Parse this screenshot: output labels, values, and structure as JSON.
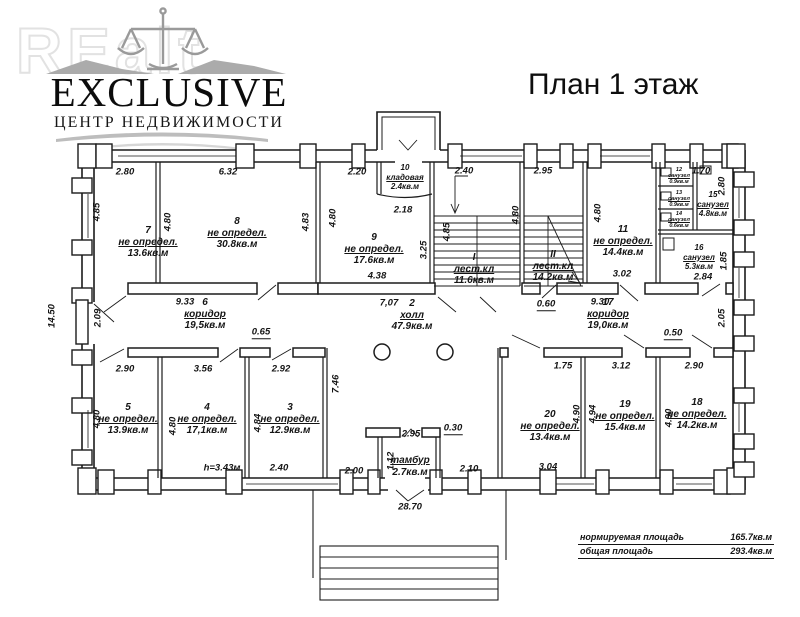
{
  "branding": {
    "watermark": "REalt",
    "logo_title": "EXCLUSIVE",
    "logo_subtitle": "ЦЕНТР НЕДВИЖИМОСТИ"
  },
  "page_title": "План 1 этаж",
  "summary": {
    "norm_label": "нормируемая площадь",
    "norm_value": "165.7кв.м",
    "total_label": "общая площадь",
    "total_value": "293.4кв.м"
  },
  "rooms": {
    "st1": {
      "num": "I",
      "name": "лест.кл",
      "area": "11.6кв.м"
    },
    "st2": {
      "num": "II",
      "name": "лест.кл",
      "area": "14.2кв.м"
    },
    "r2": {
      "num": "2",
      "name": "холл",
      "area": "47.9кв.м"
    },
    "r3": {
      "num": "3",
      "name": "не определ.",
      "area": "12.9кв.м"
    },
    "r4": {
      "num": "4",
      "name": "не определ.",
      "area": "17,1кв.м"
    },
    "r5": {
      "num": "5",
      "name": "не определ.",
      "area": "13.9кв.м"
    },
    "r6": {
      "num": "6",
      "name": "коридор",
      "area": "19,5кв.м"
    },
    "r7": {
      "num": "7",
      "name": "не определ.",
      "area": "13.6кв.м"
    },
    "r8": {
      "num": "8",
      "name": "не определ.",
      "area": "30.8кв.м"
    },
    "r9": {
      "num": "9",
      "name": "не определ.",
      "area": "17.6кв.м"
    },
    "r10": {
      "num": "10",
      "name": "кладовая",
      "area": "2.4кв.м"
    },
    "r11": {
      "num": "11",
      "name": "не определ.",
      "area": "14.4кв.м"
    },
    "r12": {
      "num": "12",
      "name": "санузел",
      "area": "0.9кв.м"
    },
    "r13": {
      "num": "13",
      "name": "санузел",
      "area": "0.9кв.м"
    },
    "r14": {
      "num": "14",
      "name": "санузел",
      "area": "0.6кв.м"
    },
    "r15": {
      "num": "15",
      "name": "санузел",
      "area": "4.8кв.м"
    },
    "r16": {
      "num": "16",
      "name": "санузел",
      "area": "5.3кв.м"
    },
    "r17": {
      "num": "17",
      "name": "коридор",
      "area": "19,0кв.м"
    },
    "r18": {
      "num": "18",
      "name": "не определ.",
      "area": "14.2кв.м"
    },
    "r19": {
      "num": "19",
      "name": "не определ.",
      "area": "15.4кв.м"
    },
    "r20": {
      "num": "20",
      "name": "не определ.",
      "area": "13.4кв.м"
    },
    "tambur": {
      "name": "тамбур",
      "area": "2.7кв.м"
    }
  },
  "notes": {
    "ceiling_height": "h=3.43м"
  },
  "dims": {
    "t1": "2.80",
    "t2": "6.32",
    "t3": "2.20",
    "t4": "2.40",
    "t5": "2.95",
    "t6": "1.70",
    "t7": "2.18",
    "m1": "9.33",
    "m2": "7,07",
    "m3": "0.60",
    "m4": "9.30",
    "m5": "4.38",
    "m6": "3.02",
    "m7": "2.84",
    "m8": "0.65",
    "m9": "2.90",
    "m10": "3.56",
    "m11": "2.92",
    "m12": "1.75",
    "m13": "3.12",
    "m14": "0.50",
    "m15": "2.90",
    "b1": "2.95",
    "b2": "0.30",
    "b3": "2.00",
    "b4": "2.10",
    "b5": "2.40",
    "b6": "3.04",
    "b7": "28.70",
    "v1": "4.85",
    "v2": "4.80",
    "v3": "4.83",
    "v4": "4.80",
    "v5": "3.25",
    "v6": "4.85",
    "v7": "4.80",
    "v8": "4.80",
    "v9": "2.80",
    "v10": "1.85",
    "v11": "14.50",
    "v12": "2.09",
    "v13": "2.05",
    "v14": "7.46",
    "v15": "4.80",
    "v16": "4.80",
    "v17": "4.84",
    "v18": "1.12",
    "v19": "4.90",
    "v20": "4.94",
    "v21": "4.90"
  }
}
